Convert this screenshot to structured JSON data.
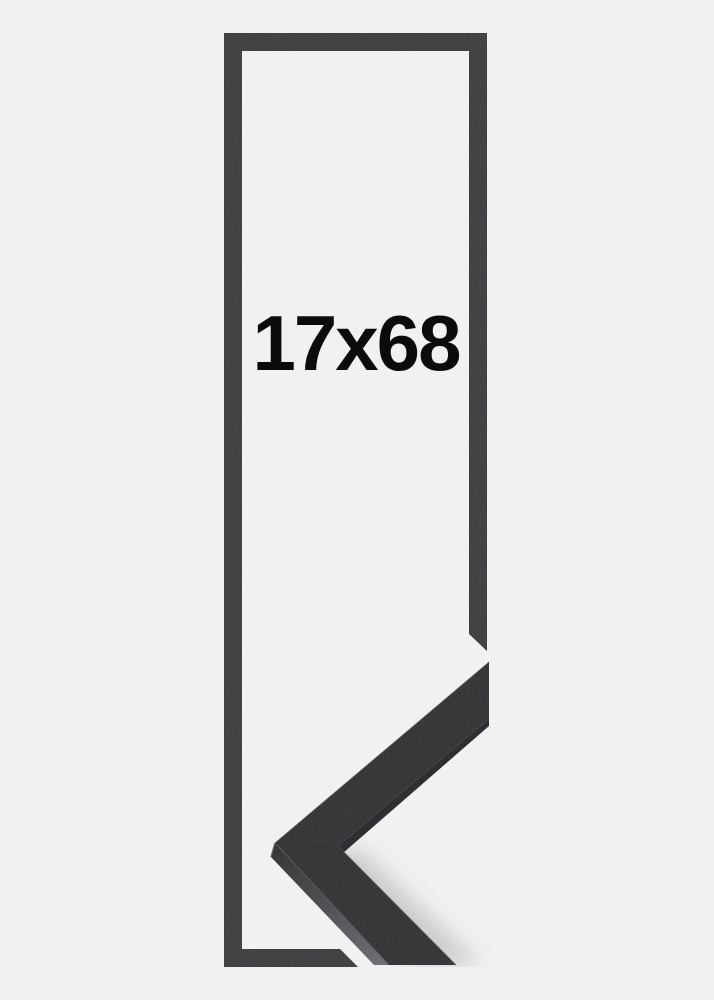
{
  "product_image": {
    "size_label": "17x68",
    "colors": {
      "background": "#f1f1f2",
      "frame_outline": "#3a3a3c",
      "corner_face": "#2f2f32",
      "corner_stripe": "#232327",
      "corner_side_dark": "#2b2b2e",
      "corner_side_light": "#6b6b70",
      "edge_highlight": "#55555a",
      "inner_edge_highlight": "#4e4e52",
      "top_edge_highlight": "#47474b",
      "miter_seam": "#1c1c1e",
      "shadow": "#3e3e44",
      "text": "#0b0b0b"
    }
  }
}
